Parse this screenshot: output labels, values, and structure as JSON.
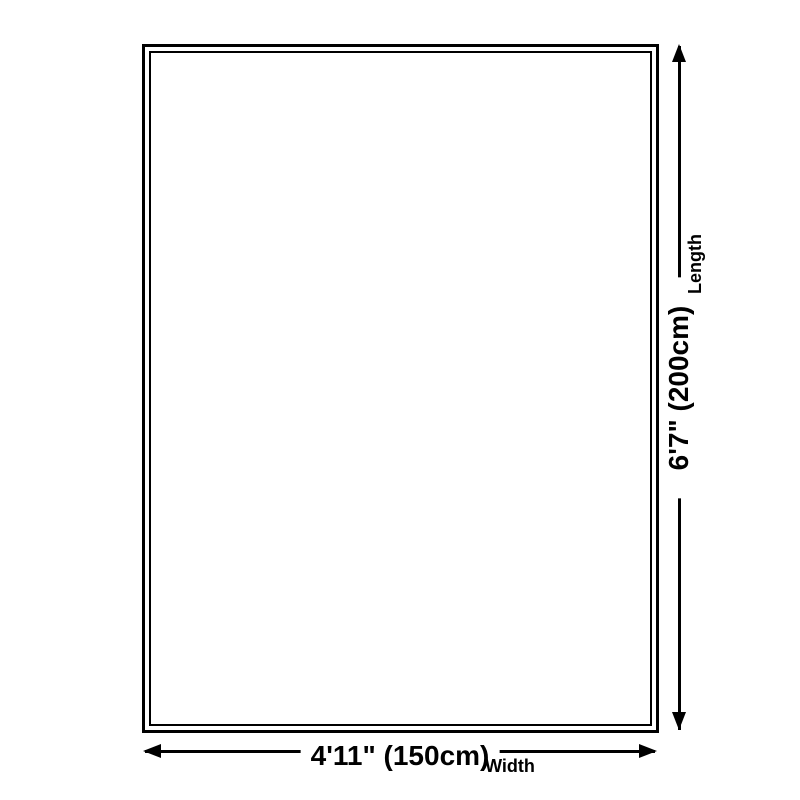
{
  "diagram": {
    "length": {
      "value": "6'7\" (200cm)",
      "label": "Length"
    },
    "width": {
      "value": "4'11\" (150cm)",
      "label": "Width"
    },
    "colors": {
      "line": "#000000",
      "text": "#000000",
      "background": "#ffffff"
    }
  }
}
